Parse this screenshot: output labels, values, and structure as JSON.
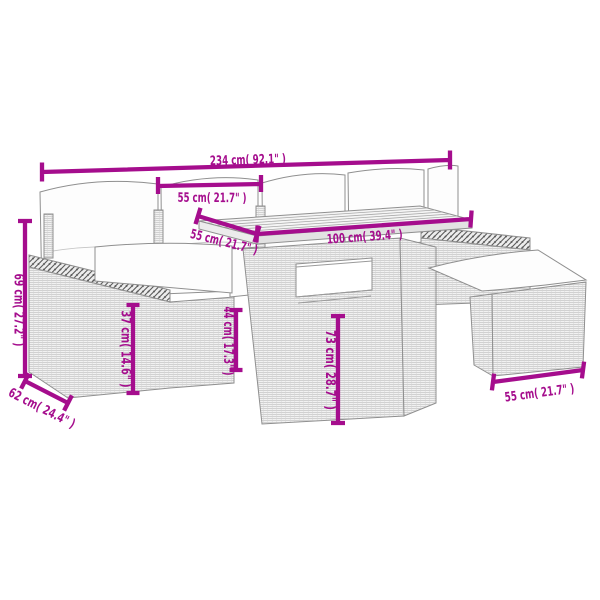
{
  "diagram": {
    "kind": "product-dimension-diagram",
    "subject": "poly rattan garden lounge set with cushions, table and ottomans (line drawing)",
    "accent_color": "#a50d8d",
    "line_art_color": "#8f8f8f",
    "background_color": "#ffffff",
    "dimensions": [
      {
        "id": "overall-width",
        "label": "234 cm( 92.1\" )"
      },
      {
        "id": "seat-width",
        "label": "55 cm( 21.7\" )"
      },
      {
        "id": "table-depth",
        "label": "55 cm( 21.7\" )"
      },
      {
        "id": "table-length",
        "label": "100 cm( 39.4\" )"
      },
      {
        "id": "back-height",
        "label": "69 cm( 27.2\" )"
      },
      {
        "id": "seat-height",
        "label": "37 cm( 14.6\" )"
      },
      {
        "id": "armrest-height",
        "label": "44 cm( 17.3\" )"
      },
      {
        "id": "table-height",
        "label": "73 cm( 28.7\" )"
      },
      {
        "id": "seat-depth",
        "label": "62 cm( 24.4\" )"
      },
      {
        "id": "stool-width",
        "label": "55 cm( 21.7\" )"
      }
    ]
  }
}
